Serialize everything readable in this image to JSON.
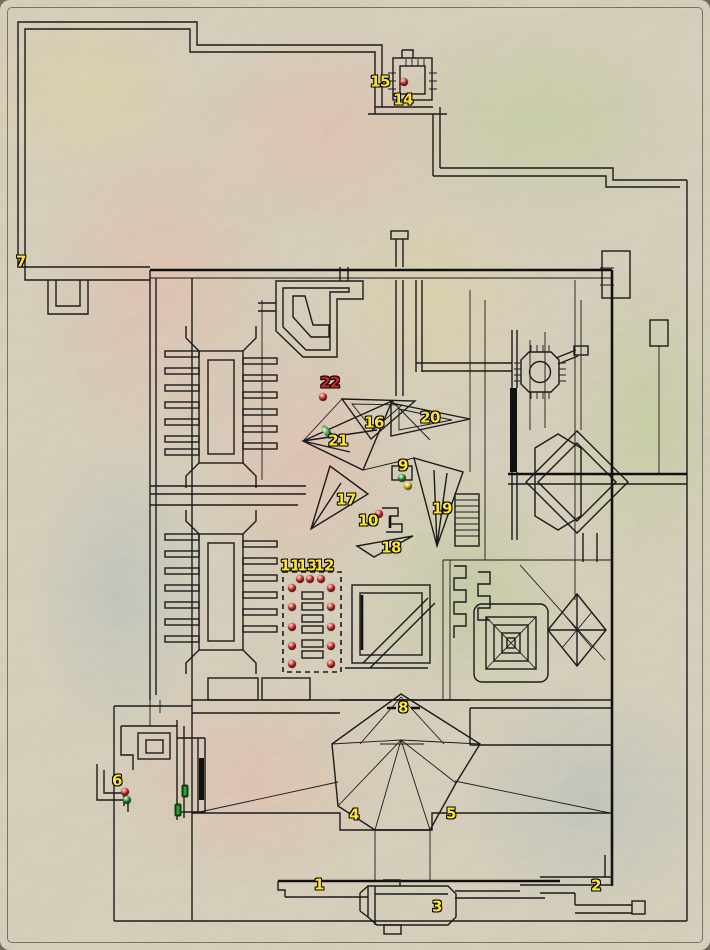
{
  "map": {
    "colors": {
      "background": "#D9D2BE",
      "ink": "#1B1B1B",
      "label_yellow": "#FFE81A",
      "label_red": "#D42222",
      "marker_red": "#E23A3A",
      "marker_green": "#2FA32F",
      "marker_yellow": "#E3CF2A"
    },
    "labels": [
      {
        "text": "1",
        "x": 319,
        "y": 885,
        "color": "yellow"
      },
      {
        "text": "2",
        "x": 596,
        "y": 886,
        "color": "yellow"
      },
      {
        "text": "3",
        "x": 437,
        "y": 907,
        "color": "yellow"
      },
      {
        "text": "4",
        "x": 354,
        "y": 815,
        "color": "yellow"
      },
      {
        "text": "5",
        "x": 451,
        "y": 814,
        "color": "yellow"
      },
      {
        "text": "6",
        "x": 117,
        "y": 781,
        "color": "yellow"
      },
      {
        "text": "7",
        "x": 21,
        "y": 262,
        "color": "yellow"
      },
      {
        "text": "8",
        "x": 403,
        "y": 708,
        "color": "yellow"
      },
      {
        "text": "9",
        "x": 403,
        "y": 466,
        "color": "yellow"
      },
      {
        "text": "10",
        "x": 368,
        "y": 521,
        "color": "yellow"
      },
      {
        "text": "11",
        "x": 290,
        "y": 566,
        "color": "yellow"
      },
      {
        "text": "13",
        "x": 307,
        "y": 566,
        "color": "yellow"
      },
      {
        "text": "12",
        "x": 324,
        "y": 566,
        "color": "yellow"
      },
      {
        "text": "14",
        "x": 403,
        "y": 100,
        "color": "yellow"
      },
      {
        "text": "15",
        "x": 380,
        "y": 82,
        "color": "yellow"
      },
      {
        "text": "16",
        "x": 374,
        "y": 423,
        "color": "yellow"
      },
      {
        "text": "17",
        "x": 346,
        "y": 500,
        "color": "yellow"
      },
      {
        "text": "18",
        "x": 391,
        "y": 548,
        "color": "yellow"
      },
      {
        "text": "19",
        "x": 442,
        "y": 509,
        "color": "yellow"
      },
      {
        "text": "20",
        "x": 430,
        "y": 418,
        "color": "yellow"
      },
      {
        "text": "21",
        "x": 338,
        "y": 441,
        "color": "yellow"
      },
      {
        "text": "22",
        "x": 330,
        "y": 383,
        "color": "red"
      }
    ],
    "markers": [
      {
        "type": "dot",
        "color": "red",
        "x": 404,
        "y": 82
      },
      {
        "type": "dot",
        "color": "red",
        "x": 323,
        "y": 397
      },
      {
        "type": "oval",
        "color": "green",
        "x": 327,
        "y": 432,
        "angle": -35
      },
      {
        "type": "dot",
        "color": "green",
        "x": 402,
        "y": 478
      },
      {
        "type": "dot",
        "color": "yellow",
        "x": 408,
        "y": 486
      },
      {
        "type": "dot",
        "color": "red",
        "x": 379,
        "y": 514
      },
      {
        "type": "dot",
        "color": "red",
        "x": 300,
        "y": 579
      },
      {
        "type": "dot",
        "color": "red",
        "x": 310,
        "y": 579
      },
      {
        "type": "dot",
        "color": "red",
        "x": 321,
        "y": 579
      },
      {
        "type": "dot",
        "color": "red",
        "x": 292,
        "y": 588
      },
      {
        "type": "dot",
        "color": "red",
        "x": 292,
        "y": 607
      },
      {
        "type": "dot",
        "color": "red",
        "x": 292,
        "y": 627
      },
      {
        "type": "dot",
        "color": "red",
        "x": 292,
        "y": 646
      },
      {
        "type": "dot",
        "color": "red",
        "x": 292,
        "y": 664
      },
      {
        "type": "dot",
        "color": "red",
        "x": 331,
        "y": 588
      },
      {
        "type": "dot",
        "color": "red",
        "x": 331,
        "y": 607
      },
      {
        "type": "dot",
        "color": "red",
        "x": 331,
        "y": 627
      },
      {
        "type": "dot",
        "color": "red",
        "x": 331,
        "y": 646
      },
      {
        "type": "dot",
        "color": "red",
        "x": 331,
        "y": 664
      },
      {
        "type": "dot",
        "color": "red",
        "x": 125,
        "y": 792
      },
      {
        "type": "dot",
        "color": "green",
        "x": 127,
        "y": 800
      },
      {
        "type": "door",
        "color": "green",
        "x": 185,
        "y": 791
      },
      {
        "type": "door",
        "color": "green",
        "x": 178,
        "y": 810
      }
    ]
  }
}
